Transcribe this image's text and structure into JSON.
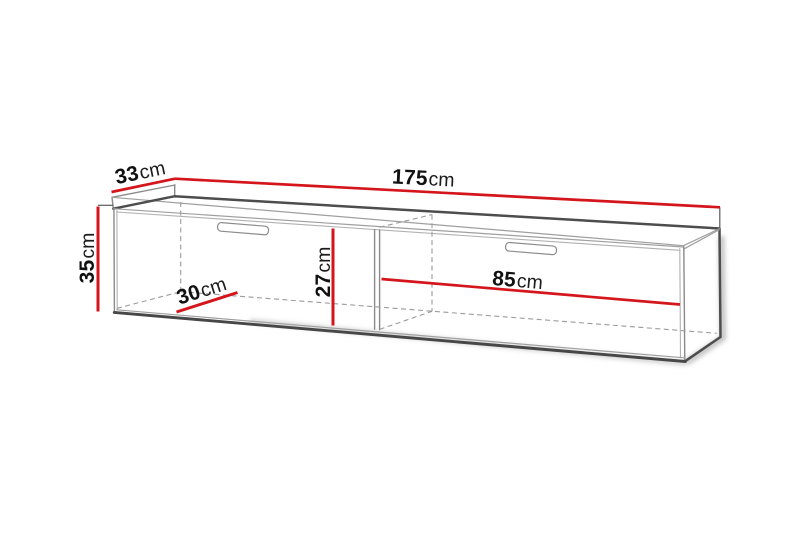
{
  "figure": {
    "kind": "furniture-dimension-diagram",
    "unit": "cm"
  },
  "dimensions": {
    "width": {
      "name": "width",
      "value": "175",
      "unit": "cm"
    },
    "depth": {
      "name": "depth",
      "value": "33",
      "unit": "cm"
    },
    "height": {
      "name": "height",
      "value": "35",
      "unit": "cm"
    },
    "interior_depth": {
      "name": "interior-depth",
      "value": "30",
      "unit": "cm"
    },
    "interior_height": {
      "name": "interior-height",
      "value": "27",
      "unit": "cm"
    },
    "compartment_width": {
      "name": "compartment-width",
      "value": "85",
      "unit": "cm"
    }
  },
  "colors": {
    "dimension_line": "#d4161c",
    "outline_dark": "#4d4d4d",
    "outline_mid": "#8a8a8a",
    "outline_light": "#a8a8a8",
    "text": "#111111",
    "background": "#ffffff"
  }
}
